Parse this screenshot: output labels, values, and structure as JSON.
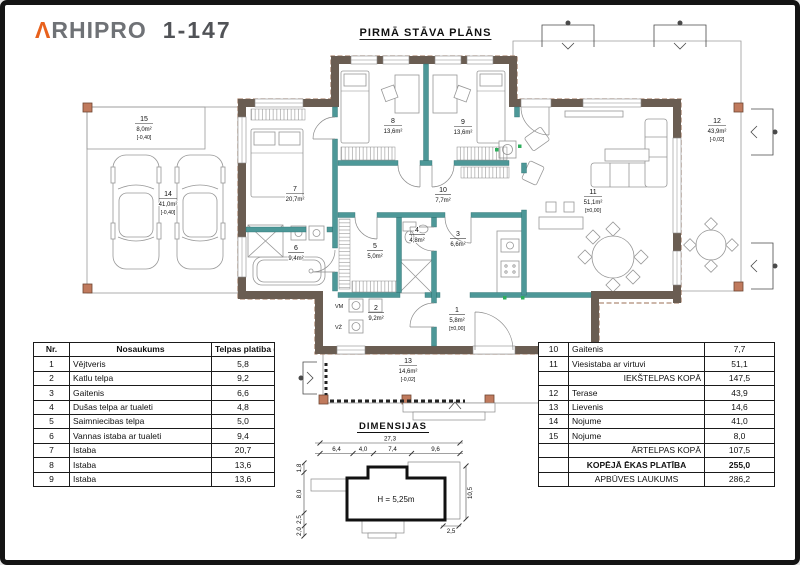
{
  "header": {
    "logo_mark": "Λ",
    "logo_name": "RHIPRO",
    "logo_code": "1-147"
  },
  "plan": {
    "title": "PIRMĀ STĀVA PLĀNS",
    "appliance_labels": {
      "washer": "VM",
      "dryer": "VŽ"
    },
    "rooms": {
      "r1": {
        "number": "1",
        "area": "5,8m²",
        "level": "[±0,00]"
      },
      "r2": {
        "number": "2",
        "area": "9,2m²",
        "level": ""
      },
      "r3": {
        "number": "3",
        "area": "6,6m²",
        "level": ""
      },
      "r4": {
        "number": "4",
        "area": "4,8m²",
        "level": ""
      },
      "r5": {
        "number": "5",
        "area": "5,0m²",
        "level": ""
      },
      "r6": {
        "number": "6",
        "area": "9,4m²",
        "level": ""
      },
      "r7": {
        "number": "7",
        "area": "20,7m²",
        "level": ""
      },
      "r8": {
        "number": "8",
        "area": "13,6m²",
        "level": ""
      },
      "r9": {
        "number": "9",
        "area": "13,6m²",
        "level": ""
      },
      "r10": {
        "number": "10",
        "area": "7,7m²",
        "level": ""
      },
      "r11": {
        "number": "11",
        "area": "51,1m²",
        "level": "[±0,00]"
      },
      "r12": {
        "number": "12",
        "area": "43,9m²",
        "level": "[-0,02]"
      },
      "r13": {
        "number": "13",
        "area": "14,6m²",
        "level": "[-0,02]"
      },
      "r14": {
        "number": "14",
        "area": "41,0m²",
        "level": "[-0,40]"
      },
      "r15": {
        "number": "15",
        "area": "8,0m²",
        "level": "[-0,40]"
      }
    }
  },
  "dimensions": {
    "title": "DIMENSIJAS",
    "total": "27,3",
    "segments": [
      "6,4",
      "4,0",
      "7,4",
      "9,6"
    ],
    "left": [
      "1,8",
      "8,0",
      "2,5",
      "2,0"
    ],
    "right": "10,5",
    "bottom_right": "2,5",
    "height_note": "H = 5,25m"
  },
  "tables": {
    "left": {
      "headers": [
        "Nr.",
        "Nosaukums",
        "Telpas platiba (m²)"
      ],
      "rows": [
        [
          "1",
          "Vējtveris",
          "5,8"
        ],
        [
          "2",
          "Katlu telpa",
          "9,2"
        ],
        [
          "3",
          "Gaitenis",
          "6,6"
        ],
        [
          "4",
          "Dušas telpa ar tualeti",
          "4,8"
        ],
        [
          "5",
          "Saimniecibas telpa",
          "5,0"
        ],
        [
          "6",
          "Vannas istaba ar tualeti",
          "9,4"
        ],
        [
          "7",
          "Istaba",
          "20,7"
        ],
        [
          "8",
          "Istaba",
          "13,6"
        ],
        [
          "9",
          "Istaba",
          "13,6"
        ]
      ]
    },
    "right": {
      "rows": [
        [
          "10",
          "Gaitenis",
          "7,7"
        ],
        [
          "11",
          "Viesistaba ar virtuvi",
          "51,1"
        ],
        [
          "",
          "IEKŠTELPAS KOPĀ",
          "147,5"
        ],
        [
          "12",
          "Terase",
          "43,9"
        ],
        [
          "13",
          "Lievenis",
          "14,6"
        ],
        [
          "14",
          "Nojume",
          "41,0"
        ],
        [
          "15",
          "Nojume",
          "8,0"
        ],
        [
          "",
          "ĀRTELPAS KOPĀ",
          "107,5"
        ],
        [
          "",
          "KOPĒJĀ ĒKAS PLATĪBA",
          "255,0"
        ],
        [
          "",
          "APBŪVES LAUKUMS",
          "286,2"
        ]
      ]
    }
  },
  "colors": {
    "accent_orange": "#E8611C",
    "exterior_wall": "#6A5D52",
    "partition_teal": "#4D9898",
    "post_brick": "#C07A5D",
    "fixture_green": "#2EAE5C"
  }
}
